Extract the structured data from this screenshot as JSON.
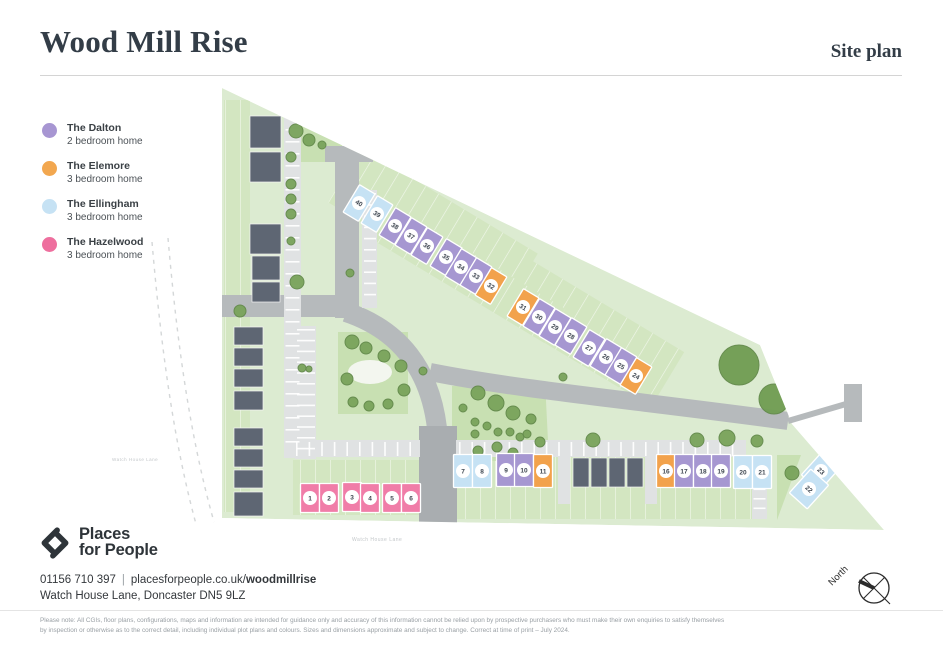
{
  "header": {
    "title": "Wood Mill Rise",
    "subtitle": "Site plan"
  },
  "legend": {
    "items": [
      {
        "name": "The Dalton",
        "desc": "2 bedroom home",
        "color": "#a796d2"
      },
      {
        "name": "The Elemore",
        "desc": "3 bedroom home",
        "color": "#f2a74f"
      },
      {
        "name": "The Ellingham",
        "desc": "3 bedroom home",
        "color": "#c6e2f4"
      },
      {
        "name": "The Hazelwood",
        "desc": "3 bedroom home",
        "color": "#ee6f9e"
      }
    ]
  },
  "map": {
    "colors": {
      "site": "#dcebd1",
      "garden": "#d3e6c1",
      "open": "#c8e0b2",
      "road": "#b6babc",
      "road_dark": "#a9adb0",
      "lane": "#e0e2e3",
      "building": "#5e6673",
      "tree": "#79a35b",
      "tree_line": "#62894a",
      "tree_big": "#6f9c52",
      "dashed": "#d4d7d8",
      "num": "#3e4650",
      "types": {
        "dalton": "#a697d1",
        "elemore": "#f2a24c",
        "ellingham": "#c6e2f4",
        "hazelwood": "#f07da8"
      }
    },
    "boundary": "222,88 760,345 792,424 884,530 222,518",
    "dashed": [
      "M168,238 C176,330 188,430 214,522",
      "M152,242 C160,335 172,436 196,524"
    ],
    "open_spaces": [
      "296,116 342,130 342,162 296,162",
      "338,332 408,332 408,414 338,414",
      "452,386 545,381 549,461 452,461",
      "777,455 801,455 777,520"
    ],
    "pond": {
      "cx": 370,
      "cy": 372,
      "rx": 22,
      "ry": 12
    },
    "gardens": [
      {
        "x": 224,
        "y": 100,
        "w": 26,
        "h": 412
      },
      {
        "x": 293,
        "y": 460,
        "w": 127,
        "h": 55
      },
      {
        "x": 456,
        "y": 455,
        "w": 307,
        "h": 64
      },
      {
        "x": 330,
        "y": 196,
        "w": 206,
        "h": 64,
        "a": 31
      },
      {
        "x": 482,
        "y": 296,
        "w": 200,
        "h": 64,
        "a": 31
      },
      {
        "x": 360,
        "y": 252,
        "w": 210,
        "h": 40,
        "a": 31
      }
    ],
    "roads": [
      {
        "d": "M222,306 H347",
        "w": 22
      },
      {
        "d": "M347,318 V156",
        "w": 24
      },
      {
        "d": "M346,312 C400,330 430,370 437,428",
        "w": 20
      },
      {
        "d": "M430,372 C520,390 650,402 788,421",
        "w": 18
      }
    ],
    "stub": "M788,421 L846,404",
    "hammer": {
      "x": 844,
      "y": 384,
      "w": 18,
      "h": 38
    },
    "road_rects": [
      {
        "x": 419,
        "y": 426,
        "w": 38,
        "h": 97,
        "dark": true
      },
      {
        "x": 325,
        "y": 146,
        "w": 48,
        "h": 16,
        "dark": false
      }
    ],
    "lanes": [
      {
        "x": 293,
        "y": 440,
        "w": 127,
        "h": 17
      },
      {
        "x": 456,
        "y": 440,
        "w": 290,
        "h": 17
      },
      {
        "x": 284,
        "y": 112,
        "w": 17,
        "h": 346
      },
      {
        "x": 295,
        "y": 326,
        "w": 21,
        "h": 133
      },
      {
        "x": 752,
        "y": 457,
        "w": 15,
        "h": 62
      },
      {
        "x": 558,
        "y": 456,
        "w": 12,
        "h": 48
      },
      {
        "x": 645,
        "y": 456,
        "w": 12,
        "h": 48
      },
      {
        "x": 362,
        "y": 190,
        "w": 15,
        "h": 118
      }
    ],
    "ticks": [
      {
        "x": 296,
        "y": 442,
        "n": 10,
        "dx": 12.6,
        "w": 1.6,
        "h": 14
      },
      {
        "x": 459,
        "y": 442,
        "n": 23,
        "dx": 12.4,
        "w": 1.6,
        "h": 14
      },
      {
        "x": 285.5,
        "y": 117,
        "n": 28,
        "dy": 12,
        "w": 14,
        "h": 1.6
      },
      {
        "x": 753.5,
        "y": 460,
        "n": 6,
        "dy": 9.5,
        "w": 12,
        "h": 1.6
      },
      {
        "x": 297,
        "y": 329,
        "n": 12,
        "dy": 10.8,
        "w": 18,
        "h": 1.6
      },
      {
        "x": 364,
        "y": 193,
        "n": 10,
        "dy": 11.2,
        "w": 12,
        "h": 1.6
      }
    ],
    "buildings": [
      {
        "x": 250,
        "y": 116,
        "w": 31,
        "h": 32
      },
      {
        "x": 250,
        "y": 152,
        "w": 31,
        "h": 30
      },
      {
        "x": 250,
        "y": 224,
        "w": 31,
        "h": 30
      },
      {
        "x": 252,
        "y": 256,
        "w": 28,
        "h": 24
      },
      {
        "x": 252,
        "y": 282,
        "w": 28,
        "h": 20
      },
      {
        "x": 234,
        "y": 327,
        "w": 29,
        "h": 18
      },
      {
        "x": 234,
        "y": 348,
        "w": 29,
        "h": 18
      },
      {
        "x": 234,
        "y": 369,
        "w": 29,
        "h": 18
      },
      {
        "x": 234,
        "y": 391,
        "w": 29,
        "h": 19
      },
      {
        "x": 234,
        "y": 428,
        "w": 29,
        "h": 18
      },
      {
        "x": 234,
        "y": 449,
        "w": 29,
        "h": 18
      },
      {
        "x": 234,
        "y": 470,
        "w": 29,
        "h": 18
      },
      {
        "x": 234,
        "y": 492,
        "w": 29,
        "h": 24
      },
      {
        "x": 573,
        "y": 458,
        "w": 16,
        "h": 29
      },
      {
        "x": 591,
        "y": 458,
        "w": 16,
        "h": 29
      },
      {
        "x": 609,
        "y": 458,
        "w": 16,
        "h": 29
      },
      {
        "x": 627,
        "y": 458,
        "w": 16,
        "h": 29
      }
    ],
    "trees": [
      [
        296,
        131,
        7
      ],
      [
        309,
        140,
        6
      ],
      [
        322,
        145,
        4
      ],
      [
        291,
        157,
        5
      ],
      [
        291,
        184,
        5
      ],
      [
        291,
        199,
        5
      ],
      [
        291,
        214,
        5
      ],
      [
        291,
        241,
        4
      ],
      [
        297,
        282,
        7
      ],
      [
        240,
        311,
        6
      ],
      [
        302,
        368,
        4
      ],
      [
        350,
        273,
        4
      ],
      [
        352,
        342,
        7
      ],
      [
        366,
        348,
        6
      ],
      [
        384,
        356,
        6
      ],
      [
        401,
        366,
        6
      ],
      [
        347,
        379,
        6
      ],
      [
        404,
        390,
        6
      ],
      [
        353,
        402,
        5
      ],
      [
        369,
        406,
        5
      ],
      [
        388,
        404,
        5
      ],
      [
        309,
        369,
        3
      ],
      [
        478,
        393,
        7
      ],
      [
        496,
        403,
        8
      ],
      [
        513,
        413,
        7
      ],
      [
        531,
        419,
        5
      ],
      [
        463,
        408,
        4
      ],
      [
        475,
        422,
        4
      ],
      [
        487,
        426,
        4
      ],
      [
        498,
        432,
        4
      ],
      [
        510,
        432,
        4
      ],
      [
        520,
        437,
        4
      ],
      [
        475,
        434,
        4
      ],
      [
        497,
        447,
        5
      ],
      [
        478,
        451,
        5
      ],
      [
        513,
        453,
        5
      ],
      [
        527,
        434,
        4
      ],
      [
        540,
        442,
        5
      ],
      [
        563,
        377,
        4
      ],
      [
        423,
        371,
        4
      ],
      [
        593,
        440,
        7
      ],
      [
        697,
        440,
        7
      ],
      [
        727,
        438,
        8
      ],
      [
        757,
        441,
        6
      ],
      [
        739,
        365,
        20
      ],
      [
        774,
        399,
        15
      ],
      [
        792,
        473,
        7
      ]
    ],
    "plots": [
      {
        "n": "40",
        "t": "ellingham",
        "x": 359,
        "y": 203,
        "a": 31,
        "w": 18,
        "h": 32
      },
      {
        "n": "39",
        "t": "ellingham",
        "x": 377,
        "y": 214,
        "a": 31,
        "w": 18,
        "h": 32
      },
      {
        "n": "38",
        "t": "dalton",
        "x": 395,
        "y": 226,
        "a": 31,
        "w": 18,
        "h": 32
      },
      {
        "n": "37",
        "t": "dalton",
        "x": 411,
        "y": 236,
        "a": 31,
        "w": 18,
        "h": 32
      },
      {
        "n": "36",
        "t": "dalton",
        "x": 427,
        "y": 246,
        "a": 31,
        "w": 18,
        "h": 32
      },
      {
        "n": "35",
        "t": "dalton",
        "x": 446,
        "y": 257,
        "a": 31,
        "w": 18,
        "h": 32
      },
      {
        "n": "34",
        "t": "dalton",
        "x": 461,
        "y": 267,
        "a": 31,
        "w": 18,
        "h": 32
      },
      {
        "n": "33",
        "t": "dalton",
        "x": 476,
        "y": 276,
        "a": 31,
        "w": 18,
        "h": 32
      },
      {
        "n": "32",
        "t": "elemore",
        "x": 491,
        "y": 286,
        "a": 31,
        "w": 18,
        "h": 32
      },
      {
        "n": "31",
        "t": "elemore",
        "x": 523,
        "y": 307,
        "a": 31,
        "w": 18,
        "h": 32
      },
      {
        "n": "30",
        "t": "dalton",
        "x": 539,
        "y": 317,
        "a": 31,
        "w": 18,
        "h": 32
      },
      {
        "n": "29",
        "t": "dalton",
        "x": 555,
        "y": 327,
        "a": 31,
        "w": 18,
        "h": 32
      },
      {
        "n": "28",
        "t": "dalton",
        "x": 571,
        "y": 336,
        "a": 31,
        "w": 18,
        "h": 32
      },
      {
        "n": "27",
        "t": "dalton",
        "x": 589,
        "y": 348,
        "a": 31,
        "w": 18,
        "h": 32
      },
      {
        "n": "26",
        "t": "dalton",
        "x": 606,
        "y": 357,
        "a": 31,
        "w": 18,
        "h": 32
      },
      {
        "n": "25",
        "t": "dalton",
        "x": 621,
        "y": 366,
        "a": 31,
        "w": 18,
        "h": 32
      },
      {
        "n": "24",
        "t": "elemore",
        "x": 636,
        "y": 376,
        "a": 31,
        "w": 18,
        "h": 32
      },
      {
        "n": "1",
        "t": "hazelwood",
        "x": 310,
        "y": 498,
        "a": 0,
        "w": 19,
        "h": 29
      },
      {
        "n": "2",
        "t": "hazelwood",
        "x": 329,
        "y": 498,
        "a": 0,
        "w": 19,
        "h": 29
      },
      {
        "n": "3",
        "t": "hazelwood",
        "x": 352,
        "y": 497,
        "a": 0,
        "w": 19,
        "h": 29
      },
      {
        "n": "4",
        "t": "hazelwood",
        "x": 370,
        "y": 498,
        "a": 0,
        "w": 19,
        "h": 29
      },
      {
        "n": "5",
        "t": "hazelwood",
        "x": 392,
        "y": 498,
        "a": 0,
        "w": 19,
        "h": 29
      },
      {
        "n": "6",
        "t": "hazelwood",
        "x": 411,
        "y": 498,
        "a": 0,
        "w": 19,
        "h": 29
      },
      {
        "n": "7",
        "t": "ellingham",
        "x": 463,
        "y": 471,
        "a": 0,
        "w": 19,
        "h": 33
      },
      {
        "n": "8",
        "t": "ellingham",
        "x": 482,
        "y": 471,
        "a": 0,
        "w": 19,
        "h": 33
      },
      {
        "n": "9",
        "t": "dalton",
        "x": 506,
        "y": 470,
        "a": 0,
        "w": 19,
        "h": 33
      },
      {
        "n": "10",
        "t": "dalton",
        "x": 524,
        "y": 470,
        "a": 0,
        "w": 19,
        "h": 33
      },
      {
        "n": "11",
        "t": "elemore",
        "x": 543,
        "y": 471,
        "a": 0,
        "w": 19,
        "h": 33
      },
      {
        "n": "16",
        "t": "elemore",
        "x": 666,
        "y": 471,
        "a": 0,
        "w": 19,
        "h": 33
      },
      {
        "n": "17",
        "t": "dalton",
        "x": 684,
        "y": 471,
        "a": 0,
        "w": 19,
        "h": 33
      },
      {
        "n": "18",
        "t": "dalton",
        "x": 703,
        "y": 471,
        "a": 0,
        "w": 19,
        "h": 33
      },
      {
        "n": "19",
        "t": "dalton",
        "x": 721,
        "y": 471,
        "a": 0,
        "w": 19,
        "h": 33
      },
      {
        "n": "20",
        "t": "ellingham",
        "x": 743,
        "y": 472,
        "a": 0,
        "w": 19,
        "h": 33
      },
      {
        "n": "21",
        "t": "ellingham",
        "x": 762,
        "y": 472,
        "a": 0,
        "w": 19,
        "h": 33
      },
      {
        "n": "23",
        "t": "ellingham",
        "x": 821,
        "y": 471,
        "a": 42,
        "w": 24,
        "h": 32
      },
      {
        "n": "22",
        "t": "ellingham",
        "x": 809,
        "y": 489,
        "a": 42,
        "w": 24,
        "h": 32
      }
    ],
    "labels": [
      {
        "t": "Watch House Lane",
        "x": 352,
        "y": 541,
        "s": 5
      },
      {
        "t": "Watch House Lane",
        "x": 112,
        "y": 461,
        "s": 4.5
      }
    ],
    "north": {
      "label": "North",
      "cx": 874,
      "cy": 588,
      "r": 15
    }
  },
  "footer": {
    "logo_line1": "Places",
    "logo_line2": "for People",
    "phone": "01156 710 397",
    "separator": "|",
    "url_prefix": "placesforpeople.co.uk/",
    "url_bold": "woodmillrise",
    "address": "Watch House Lane, Doncaster DN5 9LZ",
    "disclaimer": "Please note: All CGIs, floor plans, configurations, maps and information are intended for guidance only and accuracy of this information cannot be relied upon by prospective purchasers who must make their own enquiries to satisfy themselves by inspection or otherwise as to the correct detail, including individual plot plans and colours. Sizes and dimensions approximate and subject to change. Correct at time of print – July 2024."
  }
}
